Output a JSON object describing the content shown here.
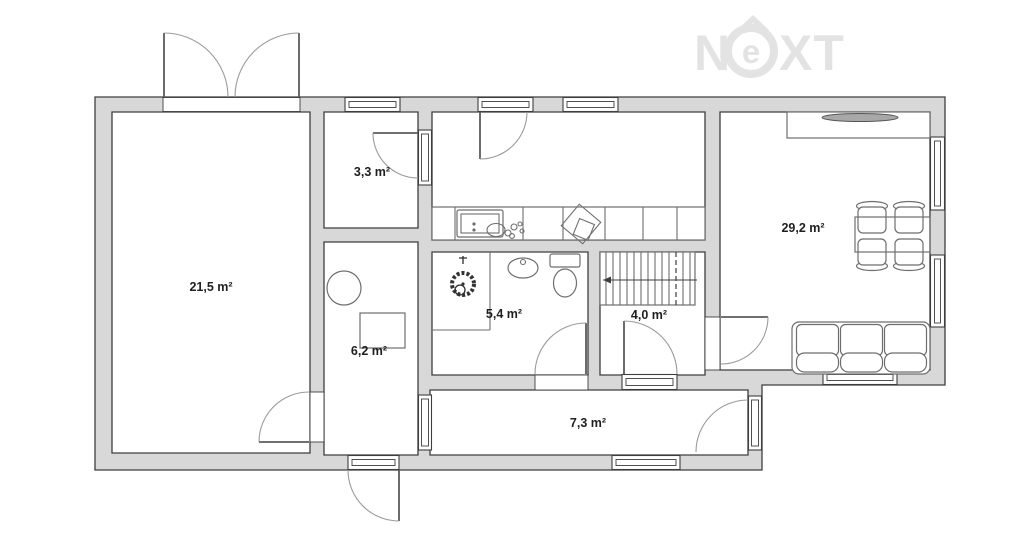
{
  "logo": {
    "text": "NEXT",
    "letter_n": "N",
    "letter_e": "e",
    "letters_xt": "XT",
    "color": "#e3e3e3"
  },
  "rooms": [
    {
      "id": "large-room",
      "area": "21,5 m²"
    },
    {
      "id": "closet",
      "area": "3,3 m²"
    },
    {
      "id": "hall",
      "area": "6,2 m²"
    },
    {
      "id": "bathroom",
      "area": "5,4 m²"
    },
    {
      "id": "stair-room",
      "area": "4,0 m²"
    },
    {
      "id": "living-room-kitchen",
      "area": "29,2 m²"
    },
    {
      "id": "corridor",
      "area": "7,3 m²"
    }
  ],
  "colors": {
    "background": "#ffffff",
    "wall_fill": "#d8d8d8",
    "wall_line": "#3e3e3e",
    "furniture_line": "#6e6e6e",
    "door_arc": "#9b9b9b",
    "label_text": "#1f1f1f",
    "logo": "#e3e3e3"
  }
}
